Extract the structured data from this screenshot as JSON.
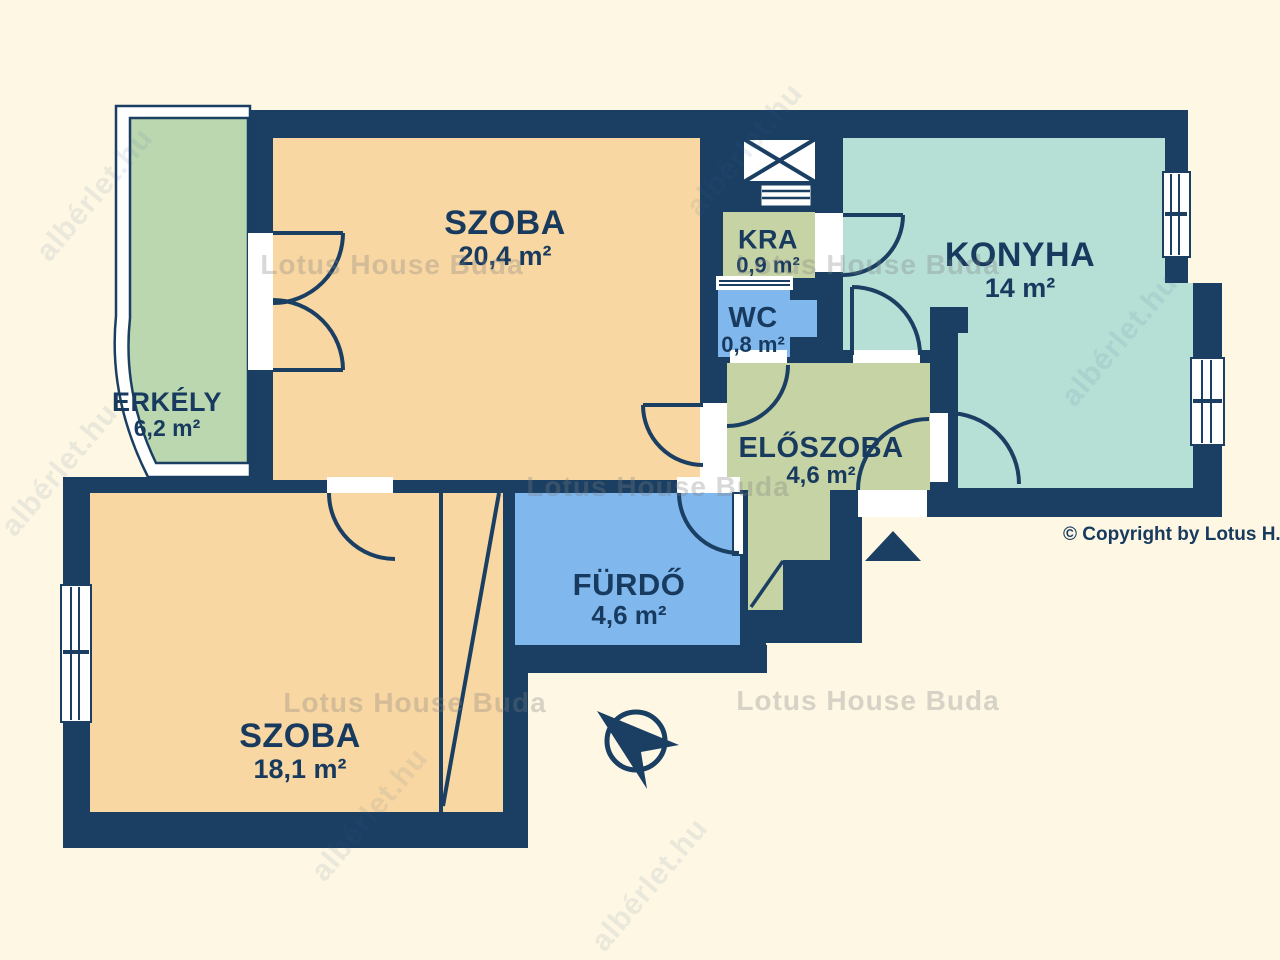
{
  "floorplan": {
    "watermark_text": "Lotus House Buda",
    "watermark_diag_text": "albérlet.hu",
    "copyright": "© Copyright by Lotus H.",
    "colors": {
      "background": "#fdf7e4",
      "wall": "#1a3f63",
      "opening": "#ffffff",
      "label": "#173a5e"
    },
    "rooms": [
      {
        "name": "SZOBA",
        "area": "20,4 m²",
        "color": "#f8d7a2"
      },
      {
        "name": "KONYHA",
        "area": "14 m²",
        "color": "#b6dfd6"
      },
      {
        "name": "KRA",
        "area": "0,9 m²",
        "color": "#c6d3a5"
      },
      {
        "name": "WC",
        "area": "0,8 m²",
        "color": "#80b7ec"
      },
      {
        "name": "ELŐSZOBA",
        "area": "4,6 m²",
        "color": "#c6d3a5"
      },
      {
        "name": "FÜRDŐ",
        "area": "4,6 m²",
        "color": "#80b7ec"
      },
      {
        "name": "SZOBA",
        "area": "18,1 m²",
        "color": "#f8d7a2"
      },
      {
        "name": "ERKÉLY",
        "area": "6,2 m²",
        "color": "#bad7b0"
      }
    ],
    "icons": {
      "compass": "compass-icon",
      "entrance_arrow": "entrance-arrow-icon"
    }
  }
}
